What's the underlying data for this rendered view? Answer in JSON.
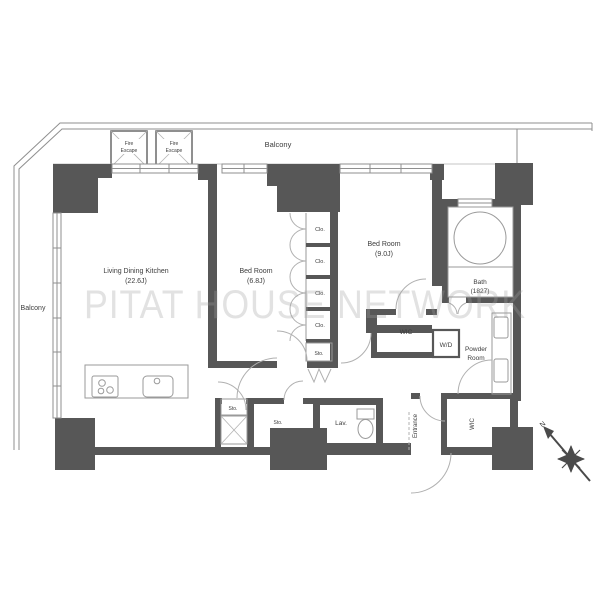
{
  "watermark": "PITAT HOUSE NETWORK",
  "labels": {
    "balcony_top": "Balcony",
    "balcony_left": "Balcony",
    "fire_escape": {
      "line1": "Fire",
      "line2": "Escape"
    },
    "ldk": {
      "name": "Living Dining Kitchen",
      "size": "(22.6J)"
    },
    "bedroom1": {
      "name": "Bed Room",
      "size": "(6.8J)"
    },
    "bedroom2": {
      "name": "Bed Room",
      "size": "(9.0J)"
    },
    "bath": {
      "name": "Bath",
      "size": "(1827)"
    },
    "wic_upper": "WIC",
    "wic_lower": "WIC",
    "washer_dryer": "W/D",
    "powder_room": {
      "line1": "Powder",
      "line2": "Room"
    },
    "entrance": "Entrance",
    "lavatory": "Lav.",
    "closet": "Clo.",
    "storage": "Sto.",
    "compass_north": "N"
  },
  "colors": {
    "wall": "#575757",
    "line": "#9a9a9a",
    "text": "#3c3c3c",
    "watermark": "#e0e0e0"
  }
}
